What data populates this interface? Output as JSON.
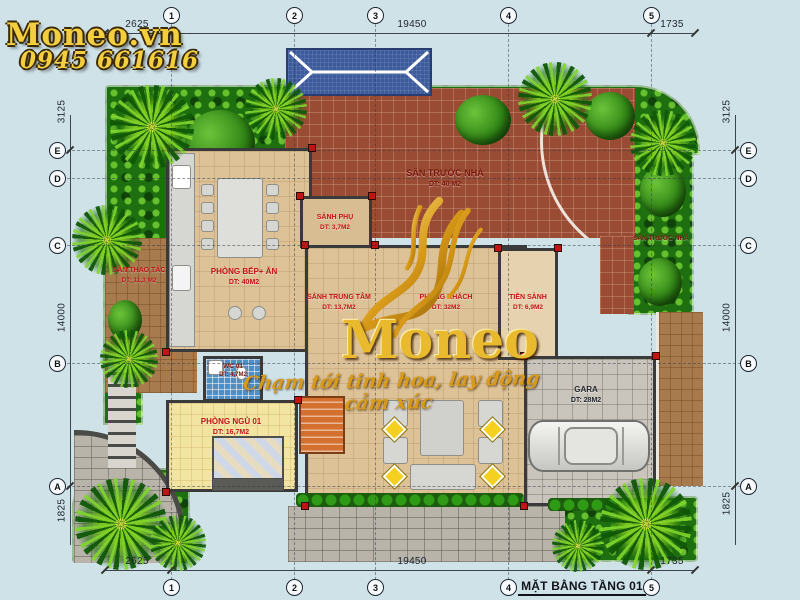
{
  "branding": {
    "logo": "Moneo.vn",
    "phone": "0945 661616",
    "watermark": "Moneo",
    "slogan": "Chạm tới tinh hoa, lay động cảm xúc"
  },
  "title": "MẶT BẰNG TẦNG 01",
  "grid": {
    "cols": [
      "1",
      "2",
      "3",
      "4",
      "5"
    ],
    "rows": [
      "E",
      "D",
      "C",
      "B",
      "A"
    ]
  },
  "dims": {
    "horizontal": [
      "2625",
      "19450",
      "1735"
    ],
    "vertical": [
      "3125",
      "14000",
      "1825"
    ]
  },
  "rooms": {
    "san_truoc_nha": {
      "name": "SÂN TRƯỚC NHÀ",
      "area": "DT: 40 M2"
    },
    "garden_strip": {
      "name": "SÂN TRƯỚC NHÀ"
    },
    "san_thao_tac": {
      "name": "SÂN THAO TÁC",
      "area": "DT: 11,3 M2"
    },
    "phong_bep_an": {
      "name": "PHÒNG BẾP+ ĂN",
      "area": "DT: 40M2"
    },
    "sanh_phu": {
      "name": "SẢNH PHỤ",
      "area": "DT: 3,7M2"
    },
    "sanh_trung_tam": {
      "name": "SẢNH TRUNG TÂM",
      "area": "DT: 13,7M2"
    },
    "phong_khach": {
      "name": "PHÒNG KHÁCH",
      "area": "DT: 32M2"
    },
    "tien_sanh": {
      "name": "TIỀN SẢNH",
      "area": "DT: 6,9M2"
    },
    "gara": {
      "name": "GARA",
      "area": "DT: 28M2"
    },
    "wc01": {
      "name": "WC 01",
      "area": "DT: 4,7M2"
    },
    "phong_ngu_01": {
      "name": "PHÒNG NGỦ 01",
      "area": "DT: 16,7M2"
    }
  },
  "colors": {
    "gold": "#f3cf3f",
    "label_red": "#c21414",
    "courtyard": "#9a4b33",
    "canopy_blue": "#3d5b9c",
    "background": "#cfe2e8"
  }
}
